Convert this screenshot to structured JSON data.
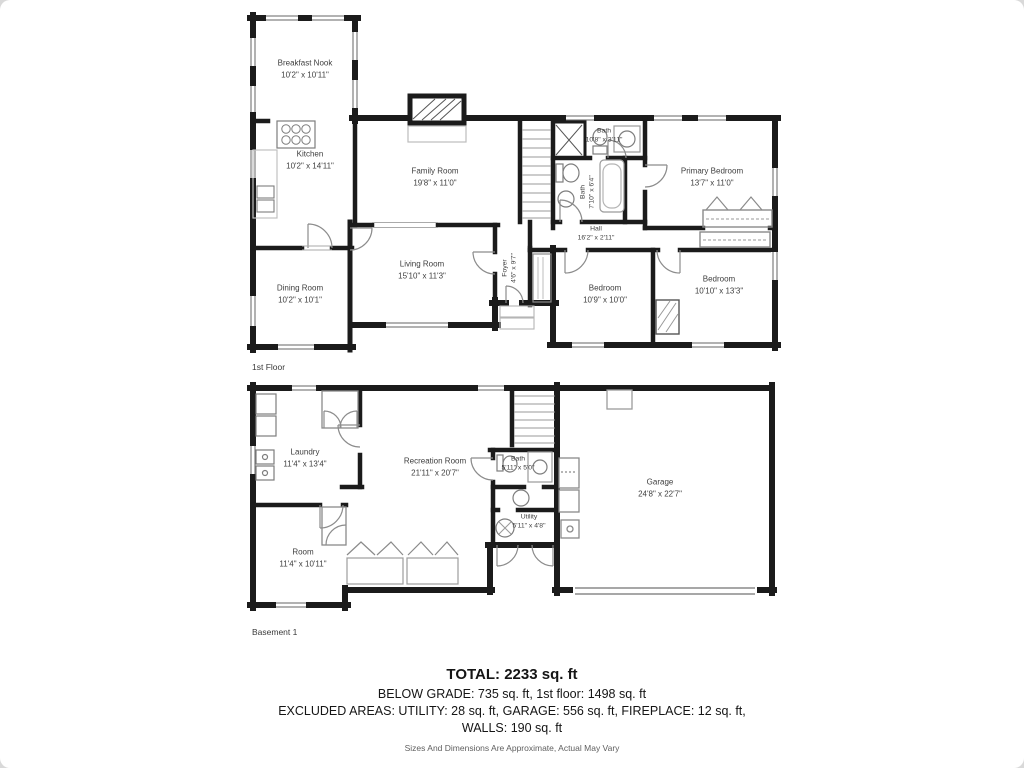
{
  "colors": {
    "wall": "#1b1b1b",
    "fixture": "#7d7d7d",
    "text": "#3e3e3e"
  },
  "floors": {
    "first": {
      "caption": "1st Floor",
      "rooms": {
        "breakfast_nook": {
          "name": "Breakfast Nook",
          "dims": "10'2\" x 10'11\""
        },
        "kitchen": {
          "name": "Kitchen",
          "dims": "10'2\" x 14'11\""
        },
        "family_room": {
          "name": "Family Room",
          "dims": "19'8\" x 11'0\""
        },
        "bath_top": {
          "name": "Bath",
          "dims": "10'8\" x 3'11\""
        },
        "bath_side": {
          "name": "Bath",
          "dims": "7'10\" x 6'4\""
        },
        "primary_bedroom": {
          "name": "Primary Bedroom",
          "dims": "13'7\" x 11'0\""
        },
        "hall": {
          "name": "Hall",
          "dims": "16'2\" x 2'11\""
        },
        "living_room": {
          "name": "Living Room",
          "dims": "15'10\" x 11'3\""
        },
        "foyer": {
          "name": "Foyer",
          "dims": "4'6\" x 9'7\""
        },
        "dining_room": {
          "name": "Dining Room",
          "dims": "10'2\" x 10'1\""
        },
        "bedroom_mid": {
          "name": "Bedroom",
          "dims": "10'9\" x 10'0\""
        },
        "bedroom_right": {
          "name": "Bedroom",
          "dims": "10'10\" x 13'3\""
        }
      }
    },
    "basement": {
      "caption": "Basement 1",
      "rooms": {
        "laundry": {
          "name": "Laundry",
          "dims": "11'4\" x 13'4\""
        },
        "recreation_room": {
          "name": "Recreation Room",
          "dims": "21'11\" x 20'7\""
        },
        "bath": {
          "name": "Bath",
          "dims": "5'11\" x 5'0\""
        },
        "utility": {
          "name": "Utility",
          "dims": "5'11\" x 4'8\""
        },
        "garage": {
          "name": "Garage",
          "dims": "24'8\" x 22'7\""
        },
        "room": {
          "name": "Room",
          "dims": "11'4\" x 10'11\""
        }
      }
    }
  },
  "summary": {
    "total": "TOTAL: 2233 sq. ft",
    "line2": "BELOW GRADE: 735 sq. ft, 1st floor: 1498 sq. ft",
    "line3": "EXCLUDED AREAS: UTILITY: 28 sq. ft, GARAGE: 556 sq. ft, FIREPLACE: 12 sq. ft,",
    "line4": "WALLS: 190 sq. ft",
    "disclaimer": "Sizes And Dimensions Are Approximate, Actual May Vary"
  }
}
